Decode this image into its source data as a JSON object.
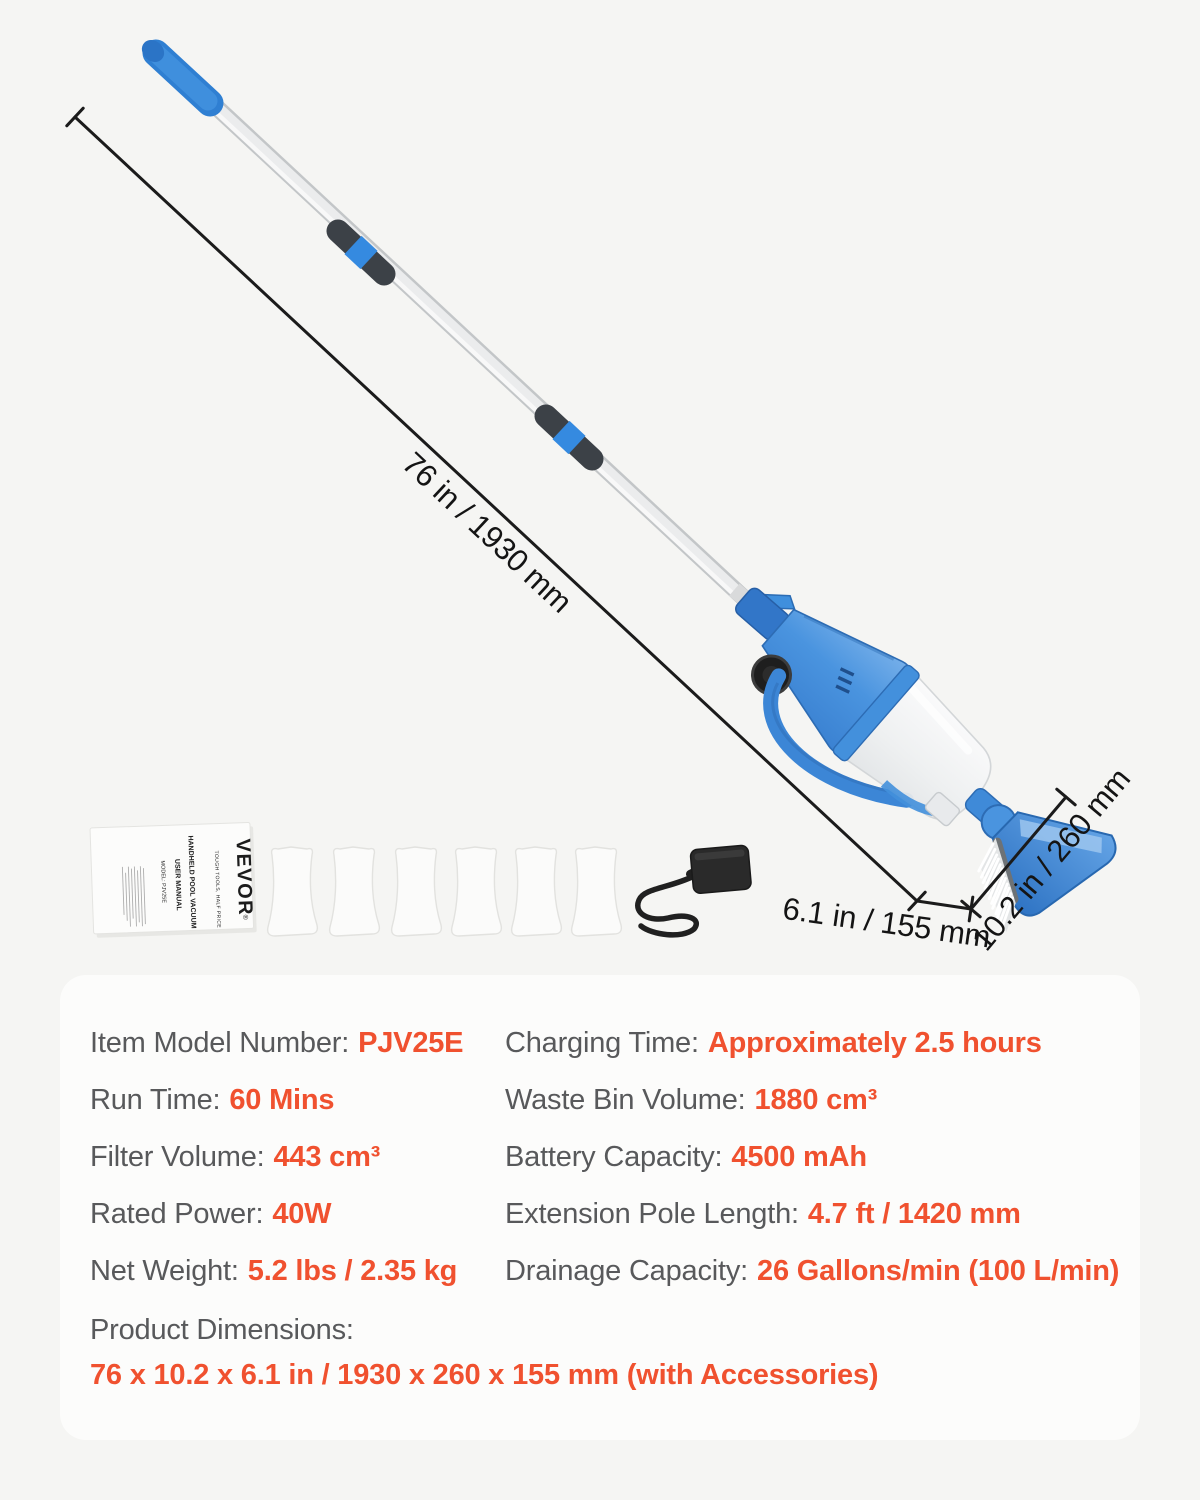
{
  "page": {
    "background": "#f5f5f3",
    "panel_background": "#fcfcfb"
  },
  "annotations": {
    "length_label": "76 in / 1930 mm",
    "depth_label": "6.1 in / 155 mm",
    "width_label": "10.2 in / 260 mm"
  },
  "manual": {
    "brand": "VEVOR",
    "registered_mark": "®",
    "tagline": "TOUGH TOOLS, HALF PRICE",
    "title": "HANDHELD POOL VACUUM",
    "subtitle": "USER MANUAL",
    "model": "MODEL: PJV25E"
  },
  "accessories": {
    "filter_bag_count": "6",
    "charger": "power-adapter",
    "manual": "user-manual"
  },
  "specs": {
    "accent_color": "#f0512f",
    "label_color": "#58595b",
    "rows_left": [
      {
        "label": "Item Model Number:",
        "value": "PJV25E"
      },
      {
        "label": "Run Time:",
        "value": "60 Mins"
      },
      {
        "label": "Filter Volume:",
        "value": "443 cm³"
      },
      {
        "label": "Rated Power:",
        "value": "40W"
      },
      {
        "label": "Net Weight:",
        "value": "5.2 lbs / 2.35 kg"
      }
    ],
    "rows_right": [
      {
        "label": "Charging Time:",
        "value": "Approximately 2.5 hours"
      },
      {
        "label": "Waste Bin Volume:",
        "value": "1880 cm³"
      },
      {
        "label": "Battery Capacity:",
        "value": "4500 mAh"
      },
      {
        "label": "Extension Pole Length:",
        "value": "4.7 ft / 1420 mm"
      },
      {
        "label": "Drainage Capacity:",
        "value": "26 Gallons/min (100 L/min)"
      }
    ],
    "dimensions_label": "Product Dimensions:",
    "dimensions_value": "76 x 10.2 x 6.1 in / 1930 x 260 x 155 mm (with Accessories)"
  }
}
